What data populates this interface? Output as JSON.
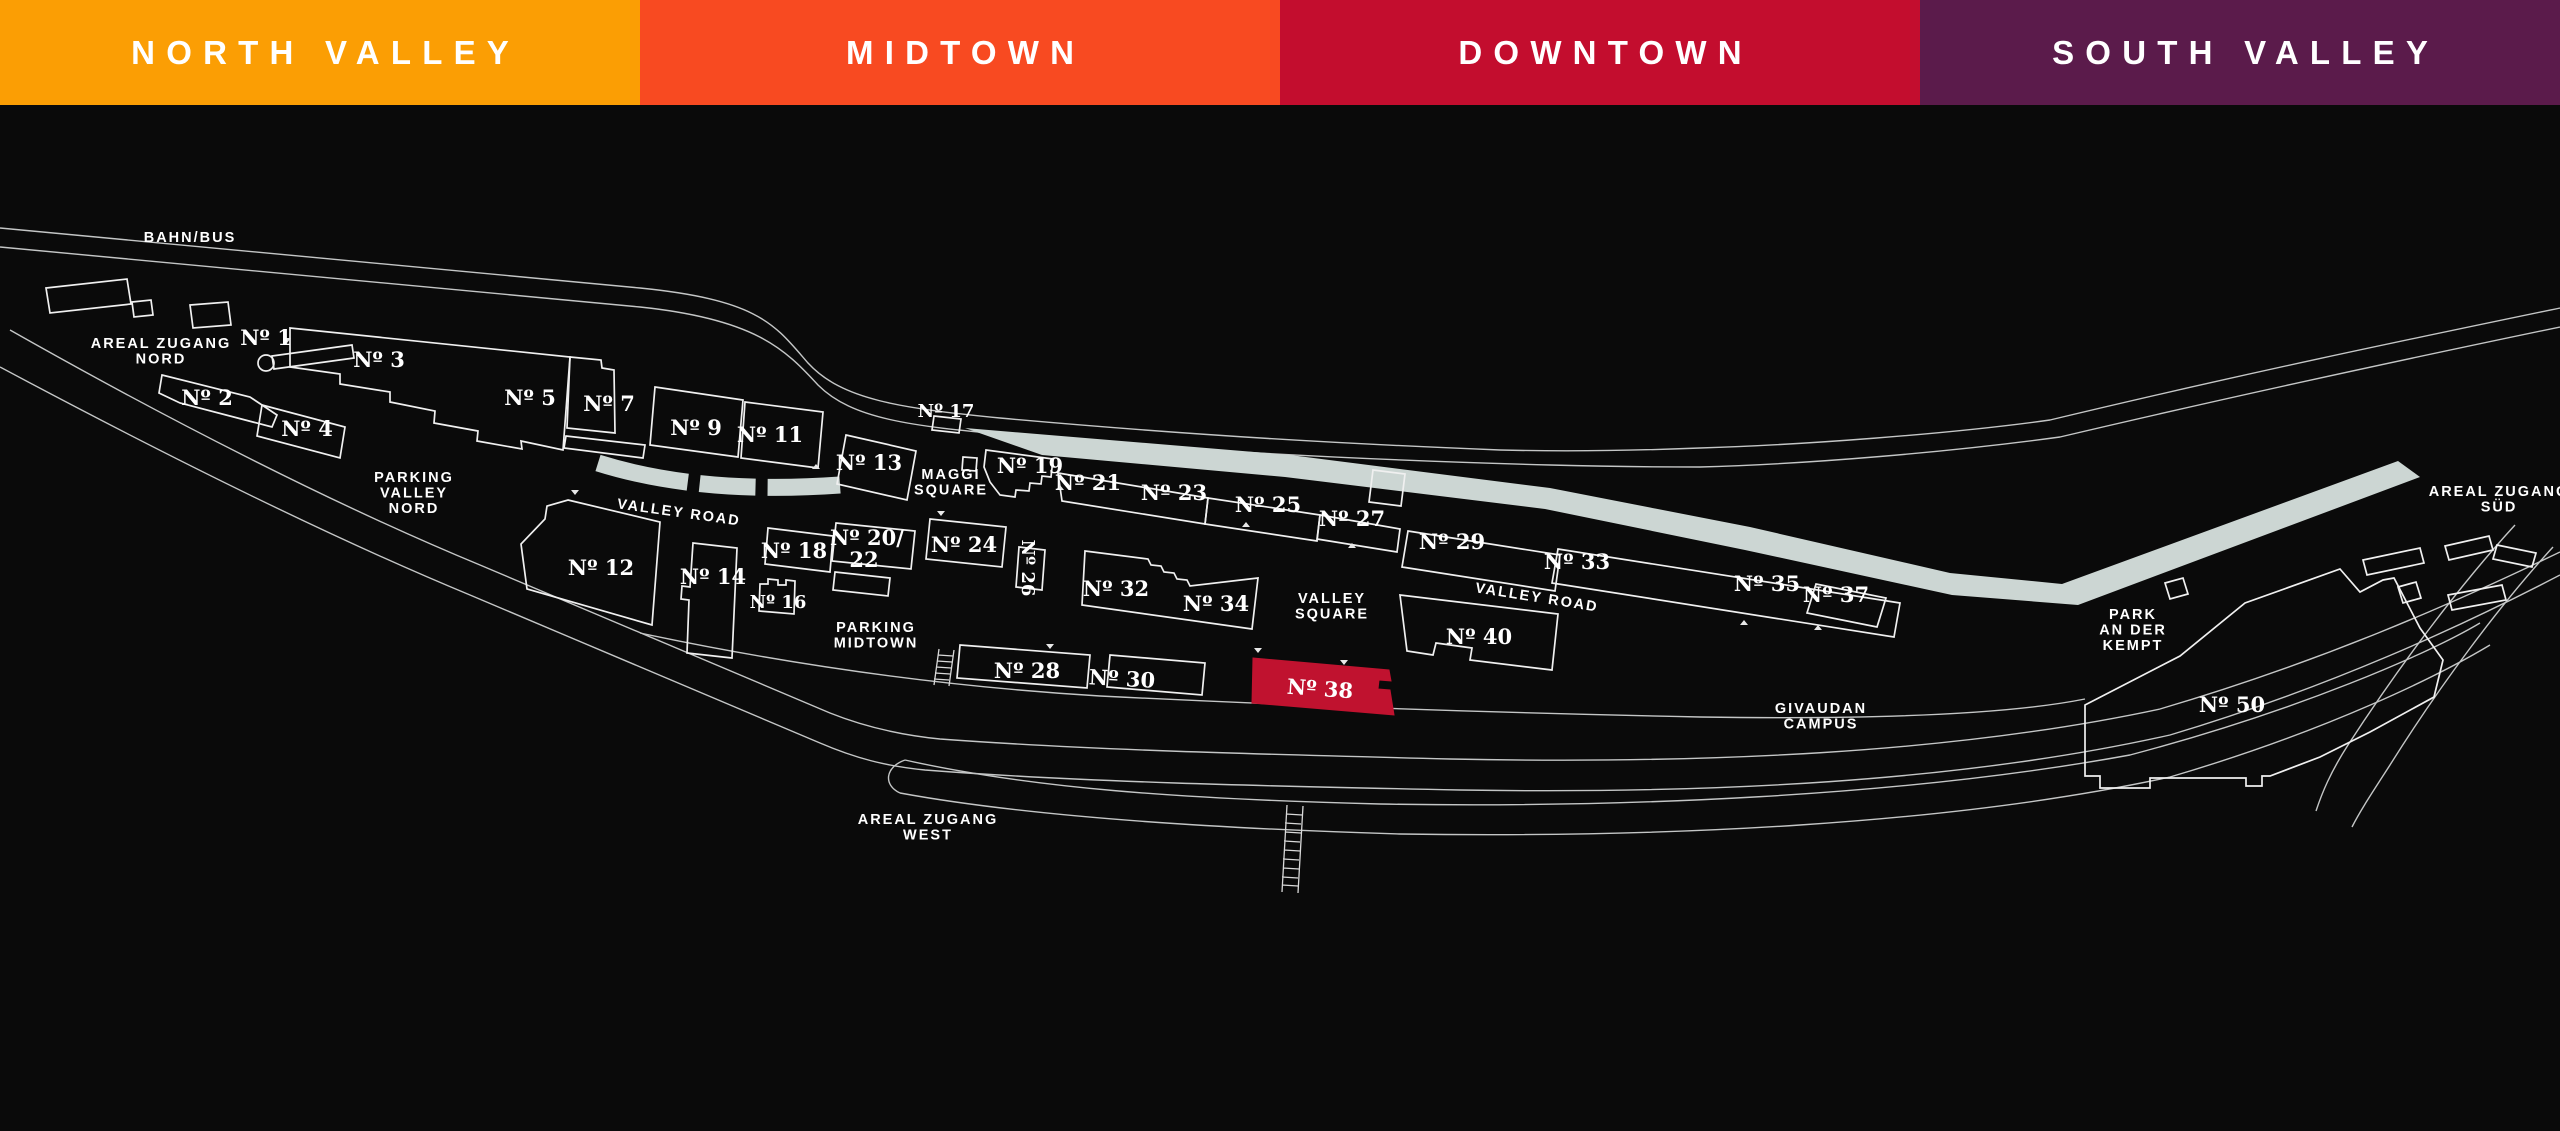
{
  "header": {
    "regions": [
      {
        "id": "north-valley",
        "label": "NORTH VALLEY",
        "color": "#FB9E04"
      },
      {
        "id": "midtown",
        "label": "MIDTOWN",
        "color": "#F84A21"
      },
      {
        "id": "downtown",
        "label": "DOWNTOWN",
        "color": "#C30D2E"
      },
      {
        "id": "south-valley",
        "label": "SOUTH VALLEY",
        "color": "#5B1B4B"
      }
    ]
  },
  "map": {
    "background_color": "#0a0a0a",
    "road_fill_color": "#ccd6d3",
    "outline_color": "#f0f0f0",
    "highlight_color": "#C0122F",
    "highlighted_building": "Nº 38",
    "buildings": [
      {
        "id": "n1",
        "label": "Nº 1",
        "x": 266,
        "y": 233,
        "rot": 0
      },
      {
        "id": "n2",
        "label": "Nº 2",
        "x": 207,
        "y": 293,
        "rot": 0
      },
      {
        "id": "n3",
        "label": "Nº 3",
        "x": 379,
        "y": 255,
        "rot": 0
      },
      {
        "id": "n4",
        "label": "Nº 4",
        "x": 307,
        "y": 324,
        "rot": 0
      },
      {
        "id": "n5",
        "label": "Nº 5",
        "x": 530,
        "y": 293,
        "rot": 0
      },
      {
        "id": "n7",
        "label": "Nº 7",
        "x": 609,
        "y": 299,
        "rot": 0
      },
      {
        "id": "n9",
        "label": "Nº 9",
        "x": 696,
        "y": 323,
        "rot": 0
      },
      {
        "id": "n11",
        "label": "Nº 11",
        "x": 770,
        "y": 330,
        "rot": 0
      },
      {
        "id": "n12",
        "label": "Nº 12",
        "x": 601,
        "y": 463,
        "rot": 0
      },
      {
        "id": "n13",
        "label": "Nº 13",
        "x": 869,
        "y": 358,
        "rot": 0
      },
      {
        "id": "n14",
        "label": "Nº 14",
        "x": 713,
        "y": 472,
        "rot": 0
      },
      {
        "id": "n16",
        "label": "Nº 16",
        "x": 778,
        "y": 496,
        "rot": 0,
        "small": true
      },
      {
        "id": "n17",
        "label": "Nº 17",
        "x": 946,
        "y": 305,
        "rot": 0,
        "small": true
      },
      {
        "id": "n18",
        "label": "Nº 18",
        "x": 794,
        "y": 446,
        "rot": 0
      },
      {
        "id": "n19",
        "label": "Nº 19",
        "x": 1030,
        "y": 361,
        "rot": 0
      },
      {
        "id": "n20",
        "label": "Nº 20/",
        "x": 867,
        "y": 433,
        "rot": 0
      },
      {
        "id": "n22",
        "label": "22",
        "x": 864,
        "y": 455,
        "rot": 0
      },
      {
        "id": "n21",
        "label": "Nº 21",
        "x": 1088,
        "y": 378,
        "rot": 0
      },
      {
        "id": "n23",
        "label": "Nº 23",
        "x": 1174,
        "y": 388,
        "rot": 0
      },
      {
        "id": "n24",
        "label": "Nº 24",
        "x": 964,
        "y": 440,
        "rot": 0
      },
      {
        "id": "n25",
        "label": "Nº 25",
        "x": 1268,
        "y": 400,
        "rot": 0
      },
      {
        "id": "n26",
        "label": "Nº 26",
        "x": 1029,
        "y": 463,
        "rot": 90,
        "small": true
      },
      {
        "id": "n27",
        "label": "Nº 27",
        "x": 1352,
        "y": 414,
        "rot": 0
      },
      {
        "id": "n28",
        "label": "Nº 28",
        "x": 1027,
        "y": 566,
        "rot": 0
      },
      {
        "id": "n29",
        "label": "Nº 29",
        "x": 1452,
        "y": 437,
        "rot": 0
      },
      {
        "id": "n30",
        "label": "Nº 30",
        "x": 1122,
        "y": 574,
        "rot": 3
      },
      {
        "id": "n32",
        "label": "Nº 32",
        "x": 1116,
        "y": 484,
        "rot": 0
      },
      {
        "id": "n33",
        "label": "Nº 33",
        "x": 1577,
        "y": 457,
        "rot": 0
      },
      {
        "id": "n34",
        "label": "Nº 34",
        "x": 1216,
        "y": 499,
        "rot": 0
      },
      {
        "id": "n35",
        "label": "Nº 35",
        "x": 1767,
        "y": 479,
        "rot": 0
      },
      {
        "id": "n37",
        "label": "Nº 37",
        "x": 1836,
        "y": 490,
        "rot": 0
      },
      {
        "id": "n38",
        "label": "Nº 38",
        "x": 1320,
        "y": 584,
        "rot": 4
      },
      {
        "id": "n40",
        "label": "Nº 40",
        "x": 1479,
        "y": 532,
        "rot": 0
      },
      {
        "id": "n50",
        "label": "Nº 50",
        "x": 2232,
        "y": 600,
        "rot": 0
      }
    ],
    "areas": [
      {
        "id": "bahn-bus",
        "lines": [
          "BAHN/BUS"
        ],
        "x": 190,
        "y": 132,
        "rot": 0
      },
      {
        "id": "areal-zugang-nord",
        "lines": [
          "AREAL ZUGANG",
          "NORD"
        ],
        "x": 161,
        "y": 238,
        "rot": 0
      },
      {
        "id": "parking-valley-nord",
        "lines": [
          "PARKING",
          "VALLEY",
          "NORD"
        ],
        "x": 414,
        "y": 372,
        "rot": 0
      },
      {
        "id": "valley-road-west",
        "lines": [
          "VALLEY ROAD"
        ],
        "x": 679,
        "y": 407,
        "rot": 8
      },
      {
        "id": "maggi-square",
        "lines": [
          "MAGGI",
          "SQUARE"
        ],
        "x": 951,
        "y": 369,
        "rot": 0
      },
      {
        "id": "parking-midtown",
        "lines": [
          "PARKING",
          "MIDTOWN"
        ],
        "x": 876,
        "y": 522,
        "rot": 0
      },
      {
        "id": "areal-zugang-west",
        "lines": [
          "AREAL ZUGANG",
          "WEST"
        ],
        "x": 928,
        "y": 714,
        "rot": 0
      },
      {
        "id": "valley-square",
        "lines": [
          "VALLEY",
          "SQUARE"
        ],
        "x": 1332,
        "y": 493,
        "rot": 0
      },
      {
        "id": "valley-road-east",
        "lines": [
          "VALLEY ROAD"
        ],
        "x": 1537,
        "y": 492,
        "rot": 9
      },
      {
        "id": "givaudan-campus",
        "lines": [
          "GIVAUDAN",
          "CAMPUS"
        ],
        "x": 1821,
        "y": 603,
        "rot": 0
      },
      {
        "id": "park-an-der-kempt",
        "lines": [
          "PARK",
          "AN DER",
          "KEMPT"
        ],
        "x": 2133,
        "y": 509,
        "rot": 0
      },
      {
        "id": "areal-zugang-sued",
        "lines": [
          "AREAL ZUGANG",
          "SÜD"
        ],
        "x": 2499,
        "y": 386,
        "rot": 0
      }
    ]
  }
}
